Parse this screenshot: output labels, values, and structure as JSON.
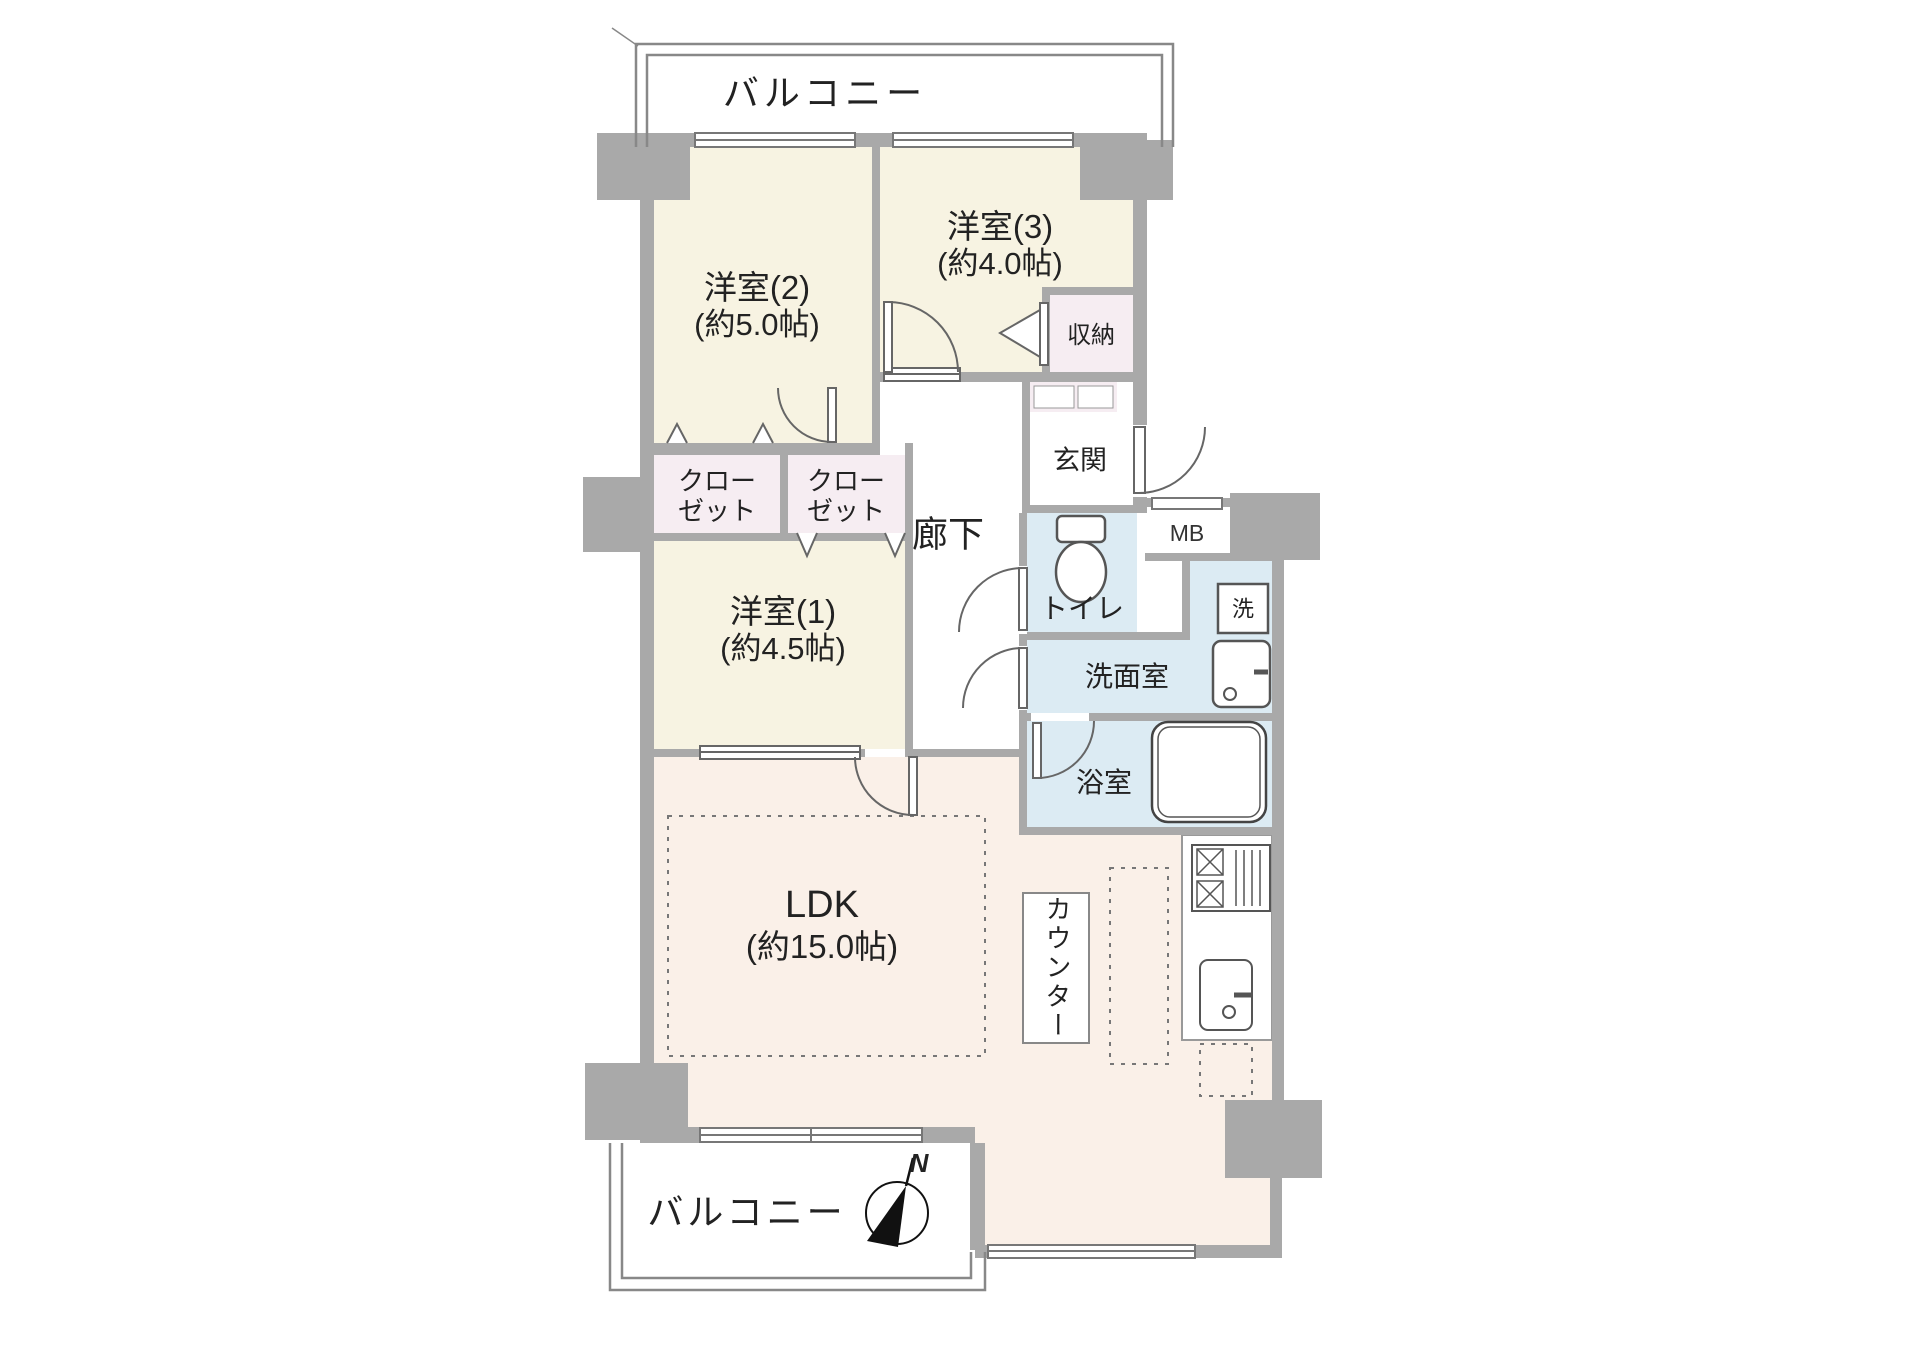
{
  "plan": {
    "type": "apartment-floor-plan",
    "labels": {
      "balcony_top": "バルコニー",
      "balcony_bottom": "バルコニー",
      "room2_name": "洋室(2)",
      "room2_size": "(約5.0帖)",
      "room3_name": "洋室(3)",
      "room3_size": "(約4.0帖)",
      "room1_name": "洋室(1)",
      "room1_size": "(約4.5帖)",
      "ldk_name": "LDK",
      "ldk_size": "(約15.0帖)",
      "storage": "収納",
      "closet1_line1": "クロー",
      "closet1_line2": "ゼット",
      "closet2_line1": "クロー",
      "closet2_line2": "ゼット",
      "genkan": "玄関",
      "hallway": "廊下",
      "toilet": "トイレ",
      "meter_box": "MB",
      "washer": "洗",
      "washroom": "洗面室",
      "bathroom": "浴室",
      "counter": "カウンター",
      "compass_north": "N"
    },
    "colors": {
      "wall_gray": "#a9a9a9",
      "room_cream": "#f7f3e2",
      "closet_pink": "#f6edf2",
      "wet_blue": "#dcebf3",
      "ldk_peach": "#faf0e8",
      "line_dark": "#555555",
      "text": "#222222"
    }
  }
}
